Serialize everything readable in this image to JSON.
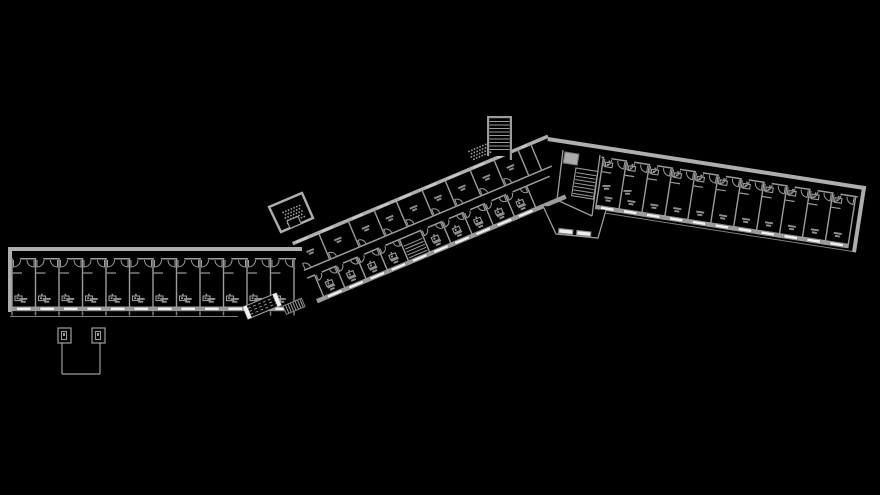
{
  "scene": {
    "width": 880,
    "height": 495,
    "bg": "#000000",
    "description": "architectural floor plan, zigzag slab building with three wings"
  },
  "palette": {
    "wall": "#9c9c9c",
    "wall_light": "#aeaeae",
    "wall_dim": "#7d7d7d",
    "window": "#efefef",
    "window_frame": "#8a8a8a",
    "fill_solid": "#ababab",
    "label": "#8f8f8f",
    "black": "#000000"
  },
  "wings": {
    "left": {
      "name": "left-wing",
      "origin": [
        8,
        247
      ],
      "angle": 0,
      "length": 294,
      "depth": 65,
      "rooms": {
        "start": 4,
        "width": 23.5,
        "count": 12
      },
      "window_width": 15,
      "fixture_pos": "bottom",
      "tick_marks": true,
      "end_wall": "left",
      "sub_line": {
        "x1": 10,
        "y1": 316.5,
        "x2": 238,
        "y2": 316.5
      }
    },
    "middle": {
      "name": "middle-wing",
      "origin": [
        292,
        242
      ],
      "angle": -22.8,
      "length": 277,
      "upper": {
        "top": 3.5,
        "bottom": 30,
        "dividers": [
          28,
          60,
          88,
          112,
          140,
          165,
          192,
          218,
          244
        ]
      },
      "corridor": {
        "top": 30,
        "bottom": 40
      },
      "lower": {
        "top": 40,
        "bottom": 62,
        "start": 8,
        "width": 23,
        "count": 10,
        "stair_index": 4
      },
      "south": {
        "top": 62,
        "wall_h": 4.5,
        "window_width": 16,
        "extent": 270
      }
    },
    "right": {
      "name": "right-wing",
      "origin": [
        548,
        137
      ],
      "angle": 8.8,
      "length": 322,
      "depth": 65,
      "rooms": {
        "start": 58,
        "width": 23.2,
        "count": 11
      },
      "window_width": 14,
      "fixture_pos": "top",
      "end_wall": "right",
      "sub_line_local": [
        60,
        66.5,
        318,
        66.5
      ]
    }
  },
  "blocks": {
    "stair_tower": {
      "x": 487,
      "y": 116,
      "w": 25,
      "h": 40,
      "tread_gap": 3.5
    },
    "tower_base_hatch": {
      "x": 468,
      "y": 151,
      "w": 20,
      "h": 12,
      "angle": -22.8
    },
    "nw_stair_block": {
      "polygon": [
        [
          269,
          207
        ],
        [
          302,
          193
        ],
        [
          313,
          218
        ],
        [
          281,
          232
        ]
      ],
      "hatch": {
        "x": 282,
        "y": 212,
        "w": 19,
        "h": 13,
        "angle": -22.8
      },
      "inner_rect": {
        "x": 287,
        "y": 221,
        "w": 12,
        "h": 8,
        "angle": -22.8
      }
    },
    "junction": {
      "south_outline": [
        [
          543,
          206
        ],
        [
          556,
          234
        ],
        [
          598,
          238
        ],
        [
          606,
          210
        ]
      ],
      "windows": [
        {
          "x": 559,
          "y": 228.5,
          "w": 14,
          "h": 4.5,
          "angle": 6
        },
        {
          "x": 577,
          "y": 230.5,
          "w": 14,
          "h": 4.5,
          "angle": 6
        }
      ],
      "elevator": {
        "x": 565,
        "y": 152,
        "w": 14,
        "h": 11,
        "angle": 9
      },
      "stair": {
        "x": 576,
        "y": 168,
        "w": 22,
        "h": 28,
        "angle": 9,
        "tread_gap": 3.5
      },
      "walls": [
        [
          563,
          150,
          557,
          200
        ],
        [
          600,
          155,
          592,
          216
        ],
        [
          557,
          200,
          592,
          216
        ]
      ]
    },
    "canopy": {
      "columns": [
        [
          62,
          330,
          62,
          374
        ],
        [
          100,
          330,
          100,
          374
        ]
      ],
      "beam": [
        62,
        374,
        100,
        374
      ],
      "boxes": [
        {
          "x": 58,
          "y": 328,
          "w": 13,
          "h": 15
        },
        {
          "x": 92,
          "y": 328,
          "w": 13,
          "h": 15
        }
      ]
    },
    "ramp": {
      "x": 243,
      "y": 307,
      "w": 36,
      "h": 13,
      "angle": -22.8,
      "dash_lines": 3
    },
    "hatch_strip": {
      "x": 283,
      "y": 306,
      "w": 20,
      "h": 9,
      "angle": -22.8
    }
  }
}
